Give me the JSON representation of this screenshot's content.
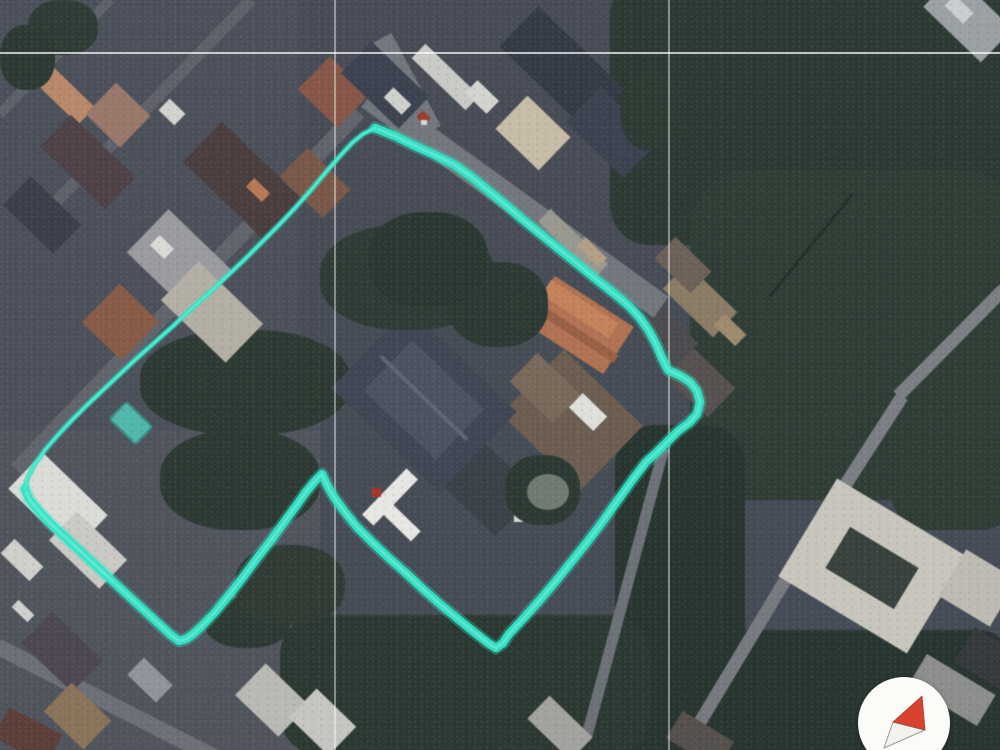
{
  "view": {
    "kind": "satellite-map",
    "width": 1000,
    "height": 750
  },
  "palette": {
    "boundary_cyan": "#31e4c6",
    "boundary_core": "#8af2de",
    "graticule_white": "#ffffff",
    "compass_face": "#fbfbf8",
    "compass_north_red": "#d7432e",
    "compass_south_white": "#f3f2ec",
    "compass_outline_gray": "#9b9b93"
  },
  "annotations": {
    "boundary_polygon": {
      "color": "#31e4c6",
      "closed": true,
      "segments": [
        {
          "name": "main-outline",
          "stroke_width": 8.5,
          "glow_width": 13,
          "core_width": 3,
          "points": [
            [
              375,
              128
            ],
            [
              395,
              136
            ],
            [
              415,
              146
            ],
            [
              435,
              155
            ],
            [
              455,
              165
            ],
            [
              473,
              178
            ],
            [
              490,
              192
            ],
            [
              506,
              205
            ],
            [
              522,
              219
            ],
            [
              538,
              232
            ],
            [
              554,
              245
            ],
            [
              570,
              258
            ],
            [
              586,
              271
            ],
            [
              602,
              284
            ],
            [
              616,
              295
            ],
            [
              629,
              306
            ],
            [
              640,
              318
            ],
            [
              649,
              331
            ],
            [
              656,
              344
            ],
            [
              662,
              358
            ],
            [
              668,
              370
            ],
            [
              679,
              375
            ],
            [
              690,
              382
            ],
            [
              697,
              391
            ],
            [
              700,
              402
            ],
            [
              697,
              414
            ],
            [
              689,
              423
            ],
            [
              678,
              431
            ],
            [
              668,
              441
            ],
            [
              657,
              452
            ],
            [
              646,
              462
            ],
            [
              633,
              479
            ],
            [
              618,
              500
            ],
            [
              603,
              521
            ],
            [
              588,
              541
            ],
            [
              572,
              561
            ],
            [
              556,
              581
            ],
            [
              539,
              601
            ],
            [
              523,
              619
            ],
            [
              509,
              634
            ],
            [
              503,
              643
            ],
            [
              496,
              648
            ],
            [
              488,
              643
            ],
            [
              474,
              632
            ],
            [
              458,
              619
            ],
            [
              441,
              605
            ],
            [
              424,
              590
            ],
            [
              407,
              574
            ],
            [
              390,
              559
            ],
            [
              373,
              543
            ],
            [
              357,
              527
            ],
            [
              344,
              511
            ],
            [
              334,
              497
            ],
            [
              327,
              485
            ],
            [
              322,
              474
            ],
            [
              315,
              481
            ],
            [
              306,
              492
            ],
            [
              296,
              506
            ],
            [
              285,
              521
            ],
            [
              272,
              539
            ],
            [
              258,
              557
            ],
            [
              244,
              576
            ],
            [
              230,
              594
            ],
            [
              216,
              611
            ],
            [
              203,
              625
            ],
            [
              192,
              635
            ],
            [
              186,
              639
            ],
            [
              179,
              641
            ],
            [
              171,
              635
            ],
            [
              159,
              624
            ],
            [
              146,
              612
            ],
            [
              133,
              600
            ],
            [
              119,
              587
            ],
            [
              105,
              574
            ],
            [
              91,
              561
            ],
            [
              77,
              548
            ],
            [
              63,
              535
            ],
            [
              50,
              523
            ],
            [
              39,
              511
            ],
            [
              29,
              499
            ],
            [
              25,
              489
            ]
          ]
        },
        {
          "name": "northwest-edge-thin",
          "stroke_width": 4,
          "glow_width": 7,
          "core_width": 1.6,
          "points": [
            [
              25,
              489
            ],
            [
              28,
              477
            ],
            [
              35,
              464
            ],
            [
              45,
              450
            ],
            [
              57,
              436
            ],
            [
              71,
              421
            ],
            [
              86,
              406
            ],
            [
              102,
              391
            ],
            [
              119,
              375
            ],
            [
              136,
              359
            ],
            [
              154,
              343
            ],
            [
              172,
              327
            ],
            [
              190,
              310
            ],
            [
              208,
              294
            ],
            [
              226,
              277
            ],
            [
              244,
              260
            ],
            [
              261,
              243
            ],
            [
              278,
              226
            ],
            [
              295,
              208
            ],
            [
              311,
              190
            ],
            [
              326,
              172
            ],
            [
              340,
              156
            ],
            [
              352,
              143
            ],
            [
              363,
              134
            ],
            [
              375,
              128
            ]
          ]
        }
      ]
    },
    "graticule": {
      "vertical_x": [
        335,
        669
      ],
      "horizontal_y": [
        53
      ],
      "line_width": 1.7,
      "vertical_opacity": 0.5,
      "horizontal_opacity": 0.8
    }
  },
  "compass": {
    "cx": 904,
    "cy": 723,
    "radius": 46,
    "needle_north_points": [
      [
        922,
        696
      ],
      [
        893,
        722
      ],
      [
        925,
        730
      ]
    ],
    "needle_south_points": [
      [
        893,
        722
      ],
      [
        884,
        748
      ],
      [
        925,
        730
      ]
    ],
    "divider_line": [
      [
        893,
        722
      ],
      [
        925,
        730
      ]
    ]
  }
}
